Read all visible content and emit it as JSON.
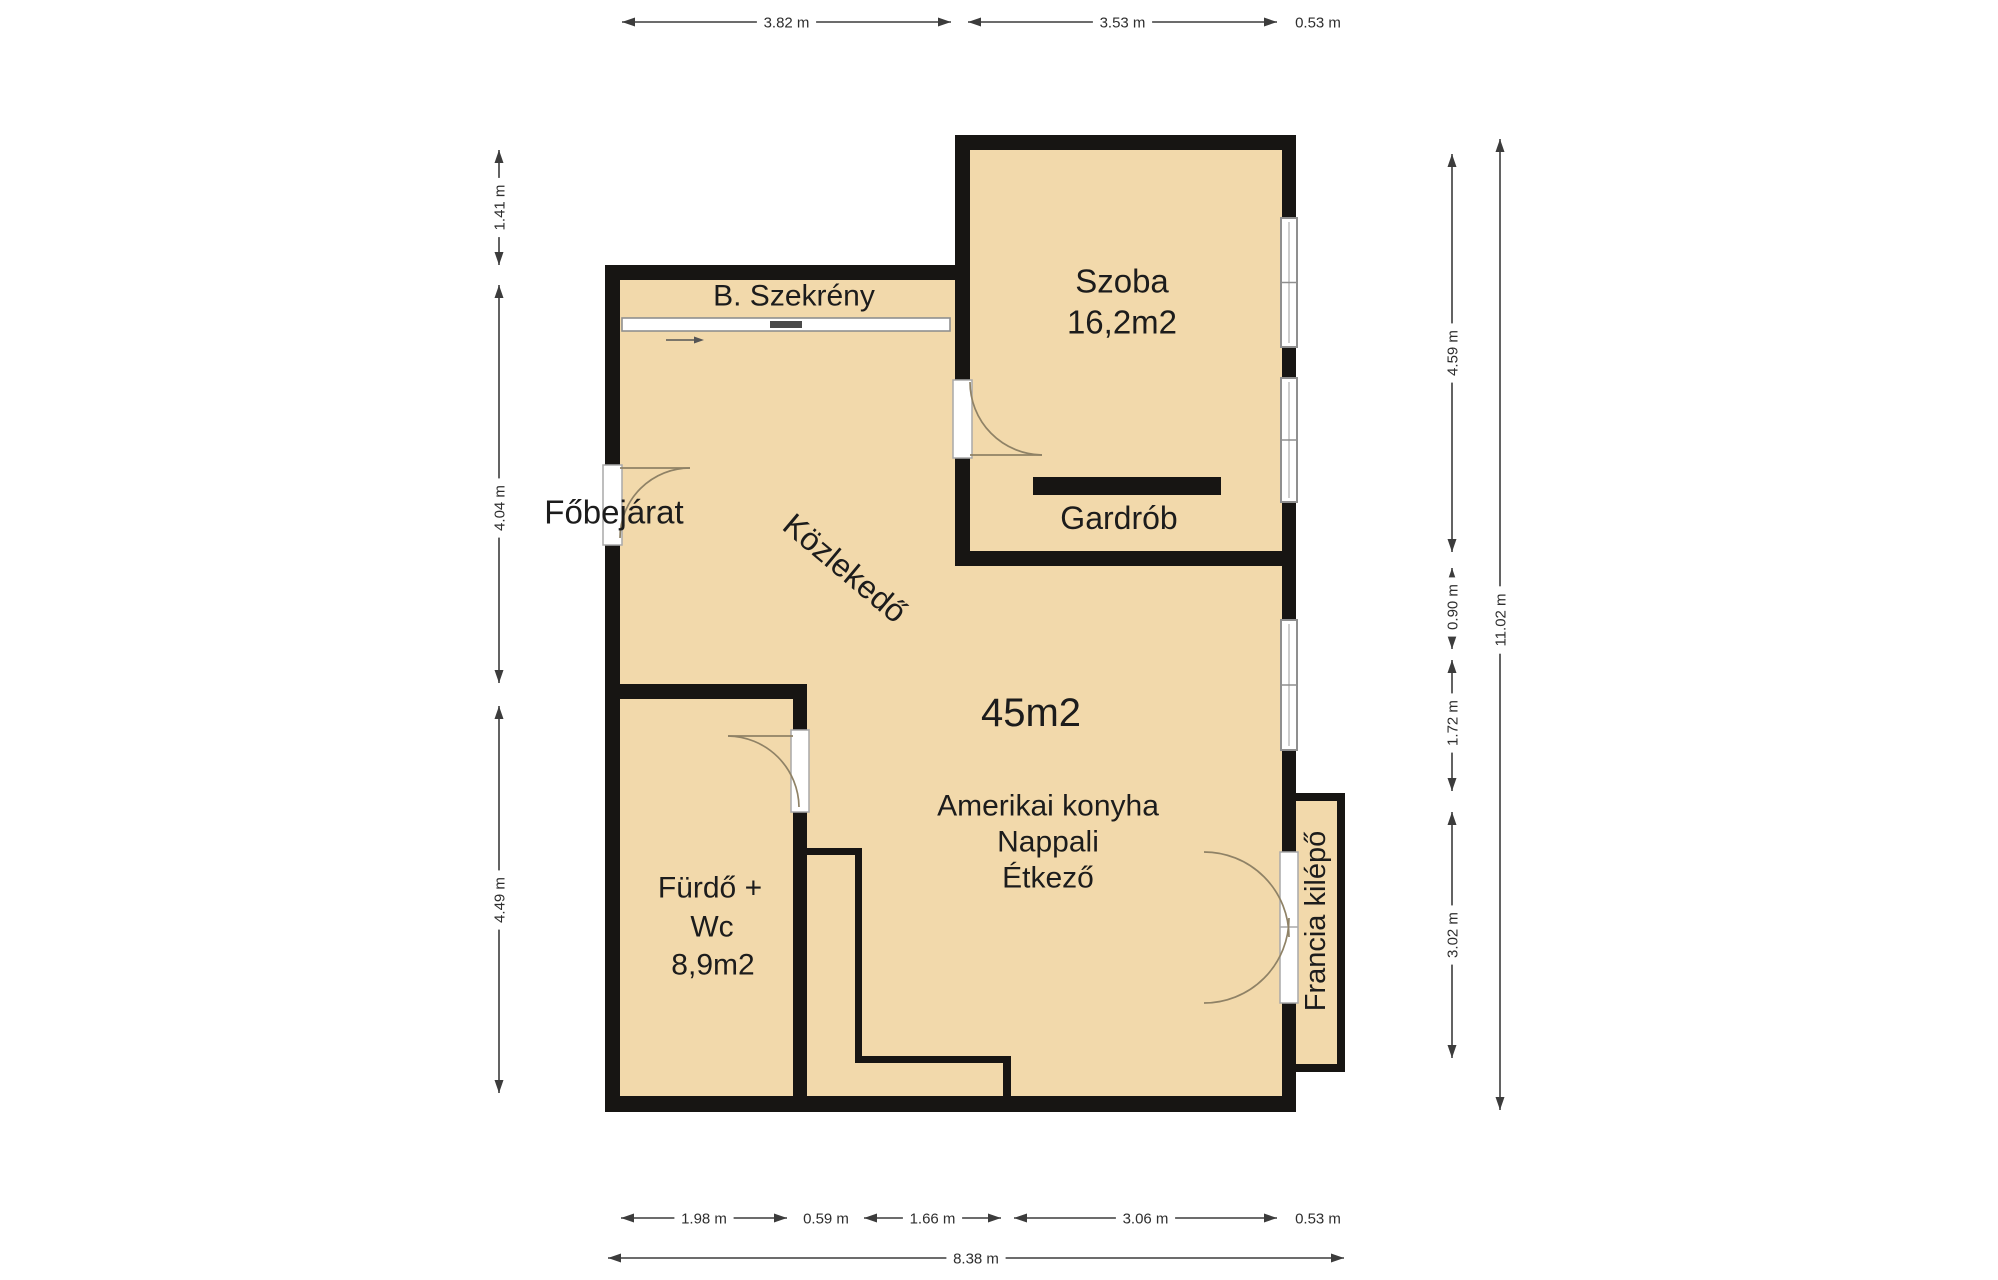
{
  "title": "Apartment floor plan",
  "rooms": {
    "fobejarat": {
      "label": "Főbejárat"
    },
    "b_szekreny": {
      "label": "B. Szekrény"
    },
    "kozlekedo": {
      "label": "Közlekedő"
    },
    "szoba": {
      "lines": [
        "Szoba",
        "16,2m2"
      ]
    },
    "gardrob": {
      "label": "Gardrób"
    },
    "nappali": {
      "area": "45m2",
      "lines": [
        "Amerikai konyha",
        "Nappali",
        "Étkező"
      ]
    },
    "furdo": {
      "lines": [
        "Fürdő +",
        "Wc",
        "8,9m2"
      ]
    },
    "francia_kilepo": {
      "label": "Francia kilépő"
    }
  },
  "dimensions": {
    "top": [
      "3.82 m",
      "3.53 m",
      "0.53 m"
    ],
    "bottom": [
      "1.98 m",
      "0.59 m",
      "1.66 m",
      "3.06 m",
      "0.53 m"
    ],
    "bottom_total": "8.38 m",
    "left": [
      "1.41 m",
      "4.04 m",
      "4.49 m"
    ],
    "right": [
      "4.59 m",
      "0.90 m",
      "1.72 m",
      "3.02 m"
    ],
    "right_total": "11.02 m"
  },
  "colors": {
    "floor": "#f2d9ab",
    "wall": "#171513",
    "dimension_line": "#3c3c3c",
    "dimension_text": "#2e2e2e",
    "door_arc": "#8f8266",
    "window_frame": "#8f8f8f",
    "label_text": "#1c1c1c",
    "background": "#ffffff"
  }
}
